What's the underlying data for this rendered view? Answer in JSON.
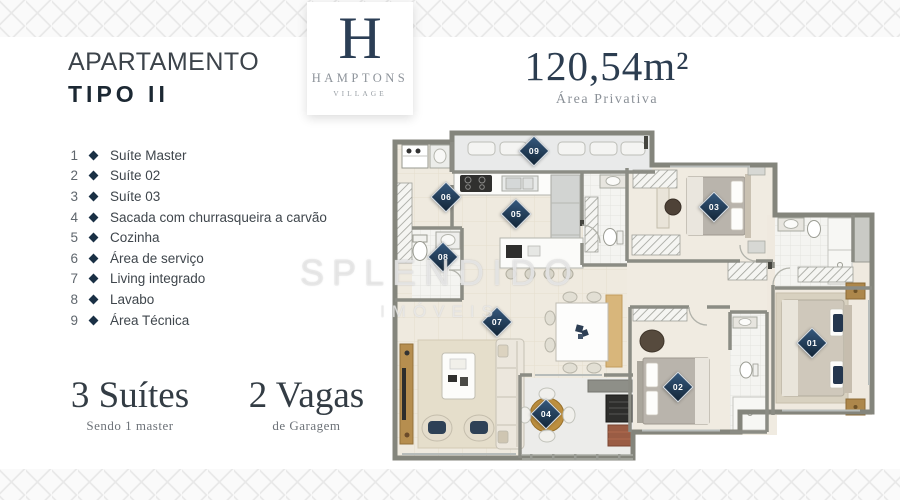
{
  "header": {
    "title_line1": "APARTAMENTO",
    "title_line2": "TIPO II",
    "logo": {
      "monogram": "H",
      "name": "HAMPTONS",
      "subname": "VILLAGE"
    },
    "area": {
      "value": "120,54m²",
      "label": "Área Privativa"
    }
  },
  "legend": {
    "items": [
      {
        "num": "1",
        "label": "Suíte Master"
      },
      {
        "num": "2",
        "label": "Suíte 02"
      },
      {
        "num": "3",
        "label": "Suíte 03"
      },
      {
        "num": "4",
        "label": "Sacada com churrasqueira a carvão"
      },
      {
        "num": "5",
        "label": "Cozinha"
      },
      {
        "num": "6",
        "label": "Área de serviço"
      },
      {
        "num": "7",
        "label": "Living integrado"
      },
      {
        "num": "8",
        "label": "Lavabo"
      },
      {
        "num": "9",
        "label": "Área Técnica"
      }
    ]
  },
  "stats": {
    "suites": {
      "value": "3 Suítes",
      "caption": "Sendo 1 master"
    },
    "vagas": {
      "value": "2 Vagas",
      "caption": "de Garagem"
    }
  },
  "watermark": {
    "line1": "SPLENDIDO",
    "line2": "IMÓVEIS"
  },
  "plan": {
    "markers": [
      {
        "label": "01"
      },
      {
        "label": "02"
      },
      {
        "label": "03"
      },
      {
        "label": "04"
      },
      {
        "label": "05"
      },
      {
        "label": "06"
      },
      {
        "label": "07"
      },
      {
        "label": "08"
      },
      {
        "label": "09"
      }
    ]
  },
  "colors": {
    "brand_navy": "#2b3e55",
    "marker_navy": "#132638",
    "legend_diamond": "#1a3045",
    "wall_gray": "#8b8c84",
    "wood": "#b98c3e"
  }
}
